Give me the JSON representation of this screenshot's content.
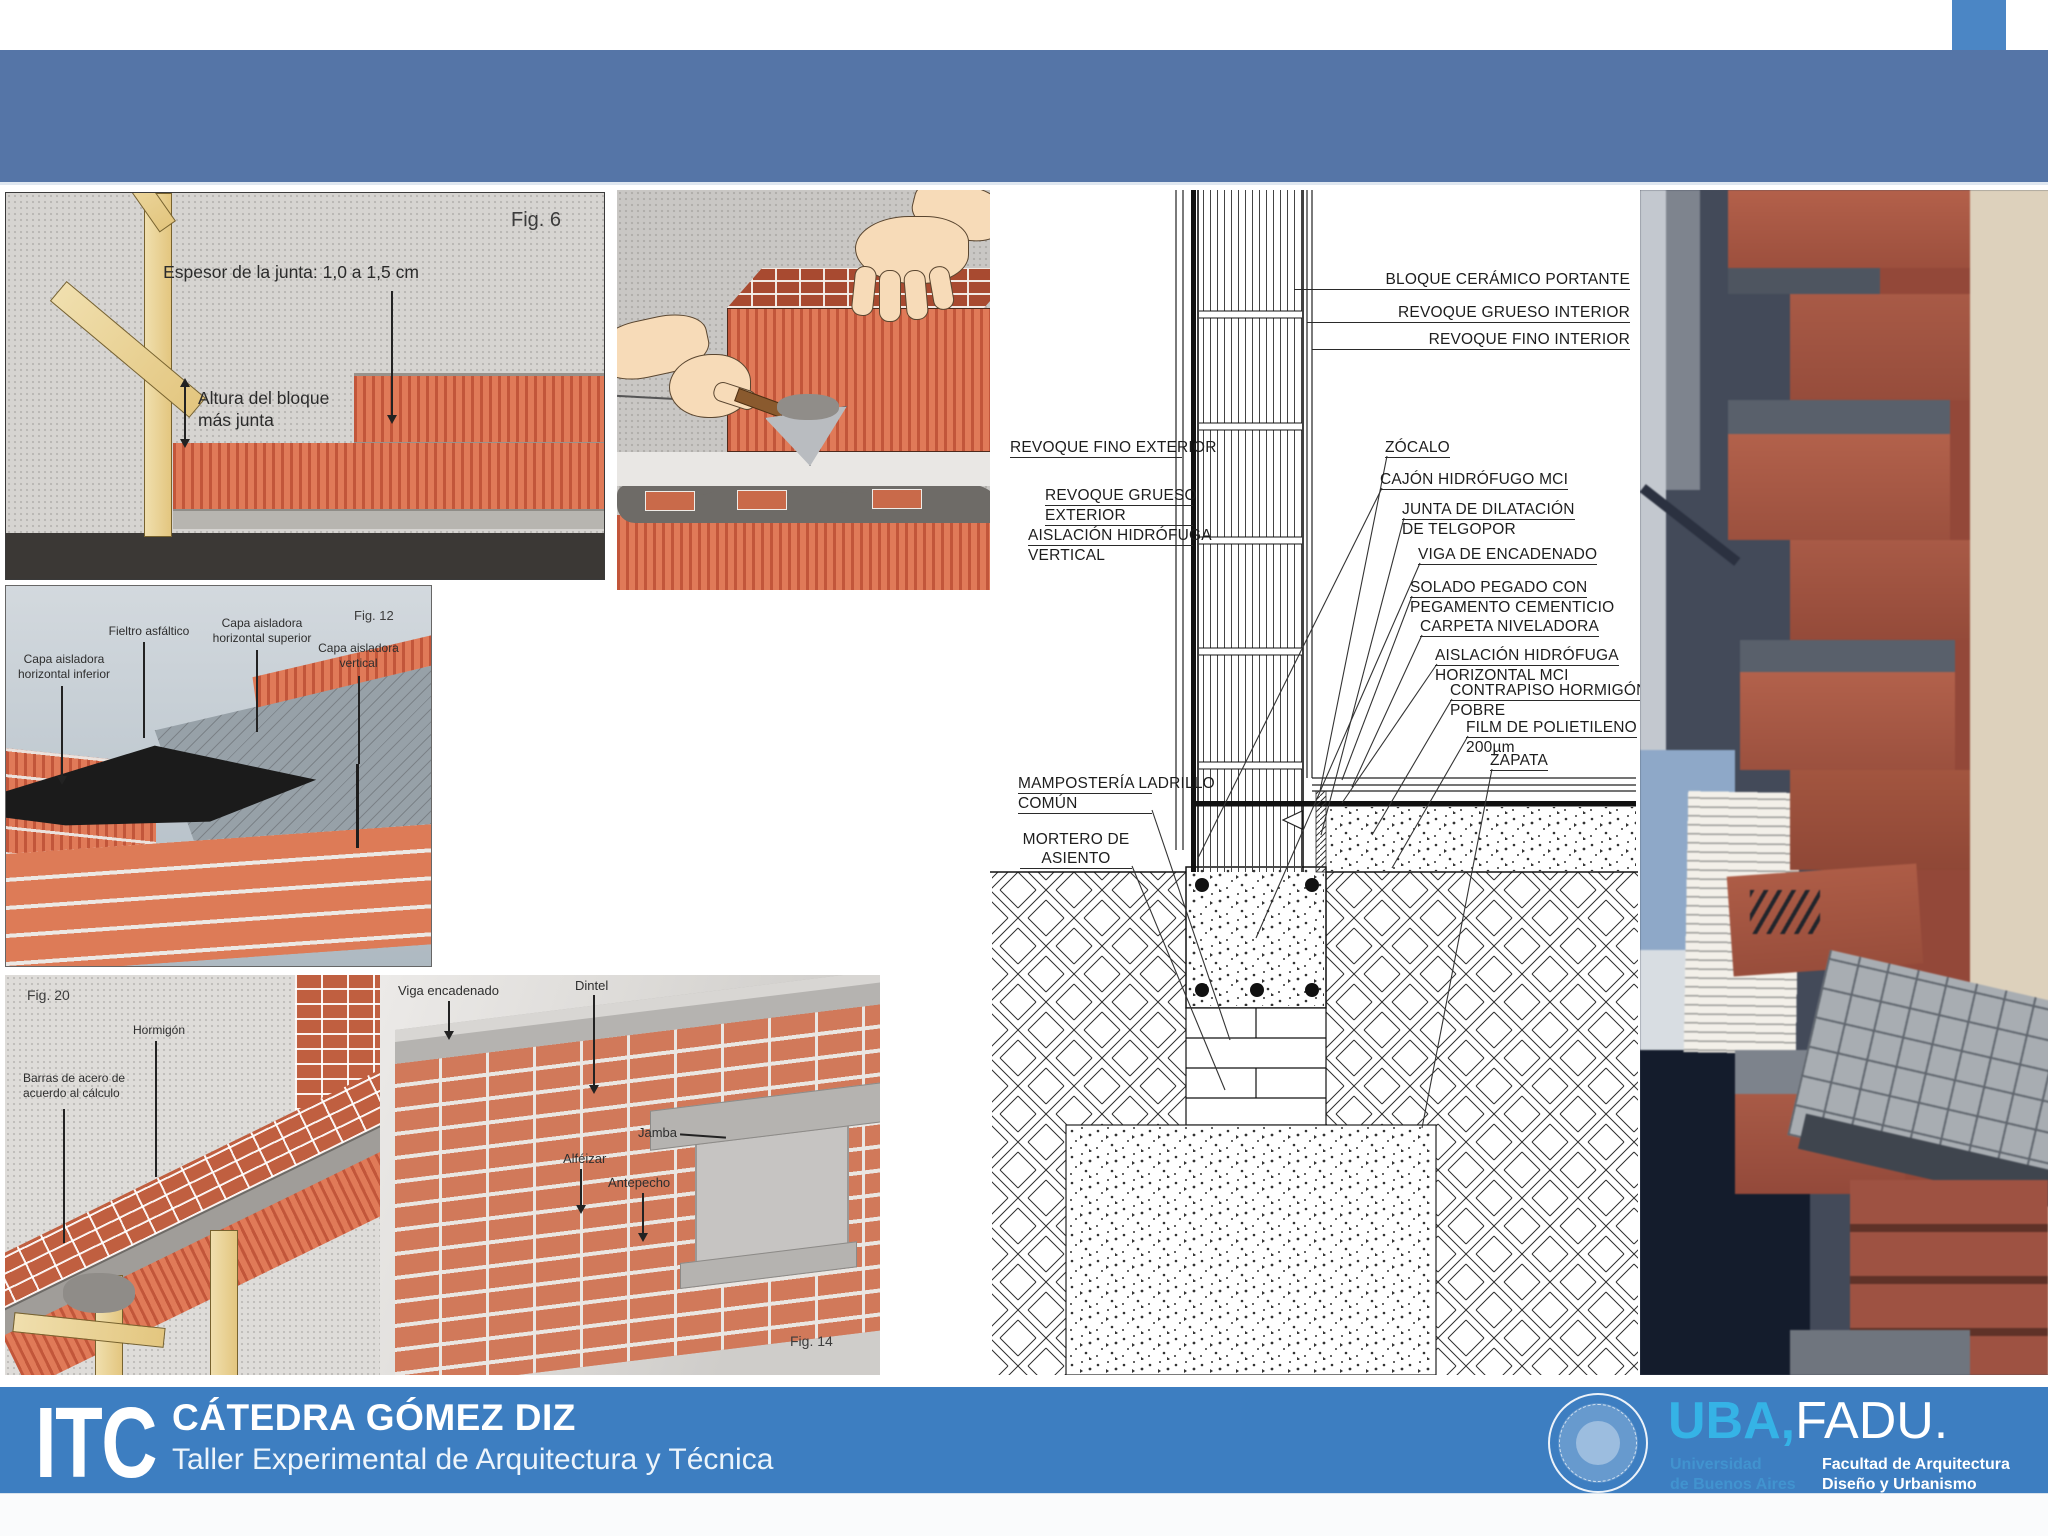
{
  "figures": {
    "fig6": {
      "tag": "Fig. 6",
      "joint": "Espesor de la junta: 1,0 a 1,5 cm",
      "height_l1": "Altura del bloque",
      "height_l2": "más junta"
    },
    "fig12": {
      "tag": "Fig. 12",
      "inferior_l1": "Capa aisladora",
      "inferior_l2": "horizontal inferior",
      "fieltro": "Fieltro asfáltico",
      "superior_l1": "Capa aisladora",
      "superior_l2": "horizontal superior",
      "vertical_l1": "Capa aisladora",
      "vertical_l2": "vertical"
    },
    "fig20": {
      "tag": "Fig. 20",
      "hormigon": "Hormigón",
      "barras_l1": "Barras de acero de",
      "barras_l2": "acuerdo al cálculo"
    },
    "fig14": {
      "tag": "Fig. 14",
      "viga": "Viga encadenado",
      "dintel": "Dintel",
      "jamba": "Jamba",
      "alfeizar": "Alféizar",
      "antepecho": "Antepecho"
    }
  },
  "detail": {
    "bloque": "BLOQUE CERÁMICO PORTANTE",
    "revoque_grueso_int": "REVOQUE GRUESO INTERIOR",
    "revoque_fino_int": "REVOQUE FINO INTERIOR",
    "revoque_fino_ext": "REVOQUE FINO EXTERIOR",
    "revoque_grueso_ext_l1": "REVOQUE GRUESO",
    "revoque_grueso_ext_l2": "EXTERIOR",
    "aislacion_v_l1": "AISLACIÓN HIDRÓFUGA",
    "aislacion_v_l2": "VERTICAL",
    "mamposteria_l1": "MAMPOSTERÍA LADRILLO",
    "mamposteria_l2": "COMÚN",
    "mortero_l1": "MORTERO DE",
    "mortero_l2": "ASIENTO",
    "zocalo": "ZÓCALO",
    "cajon": "CAJÓN HIDRÓFUGO MCI",
    "junta_l1": "JUNTA DE DILATACIÓN",
    "junta_l2": "DE TELGOPOR",
    "viga": "VIGA DE ENCADENADO",
    "solado_l1": "SOLADO PEGADO CON",
    "solado_l2": "PEGAMENTO CEMENTICIO",
    "carpeta": "CARPETA NIVELADORA",
    "aislacion_h_l1": "AISLACIÓN HIDRÓFUGA",
    "aislacion_h_l2": "HORIZONTAL MCI",
    "contrapiso_l1": "CONTRAPISO HORMIGÓN",
    "contrapiso_l2": "POBRE",
    "film_l1": "FILM DE POLIETILENO",
    "film_l2": "200µm",
    "zapata": "ZAPATA"
  },
  "footer": {
    "logo": "ITC",
    "title": "CÁTEDRA GÓMEZ DIZ",
    "subtitle": "Taller Experimental de Arquitectura y Técnica",
    "uba": "UBA,",
    "fadu": "FADU.",
    "uni_l1": "Universidad",
    "uni_l2": "de Buenos Aires",
    "fac_l1": "Facultad de Arquitectura",
    "fac_l2": "Diseño y Urbanismo"
  },
  "colors": {
    "top_band": "#5575a7",
    "corner_square": "#4b86c5",
    "footer_band": "#3d7ec1",
    "uba_cyan": "#35b3e6",
    "brick": "#dd7352"
  }
}
